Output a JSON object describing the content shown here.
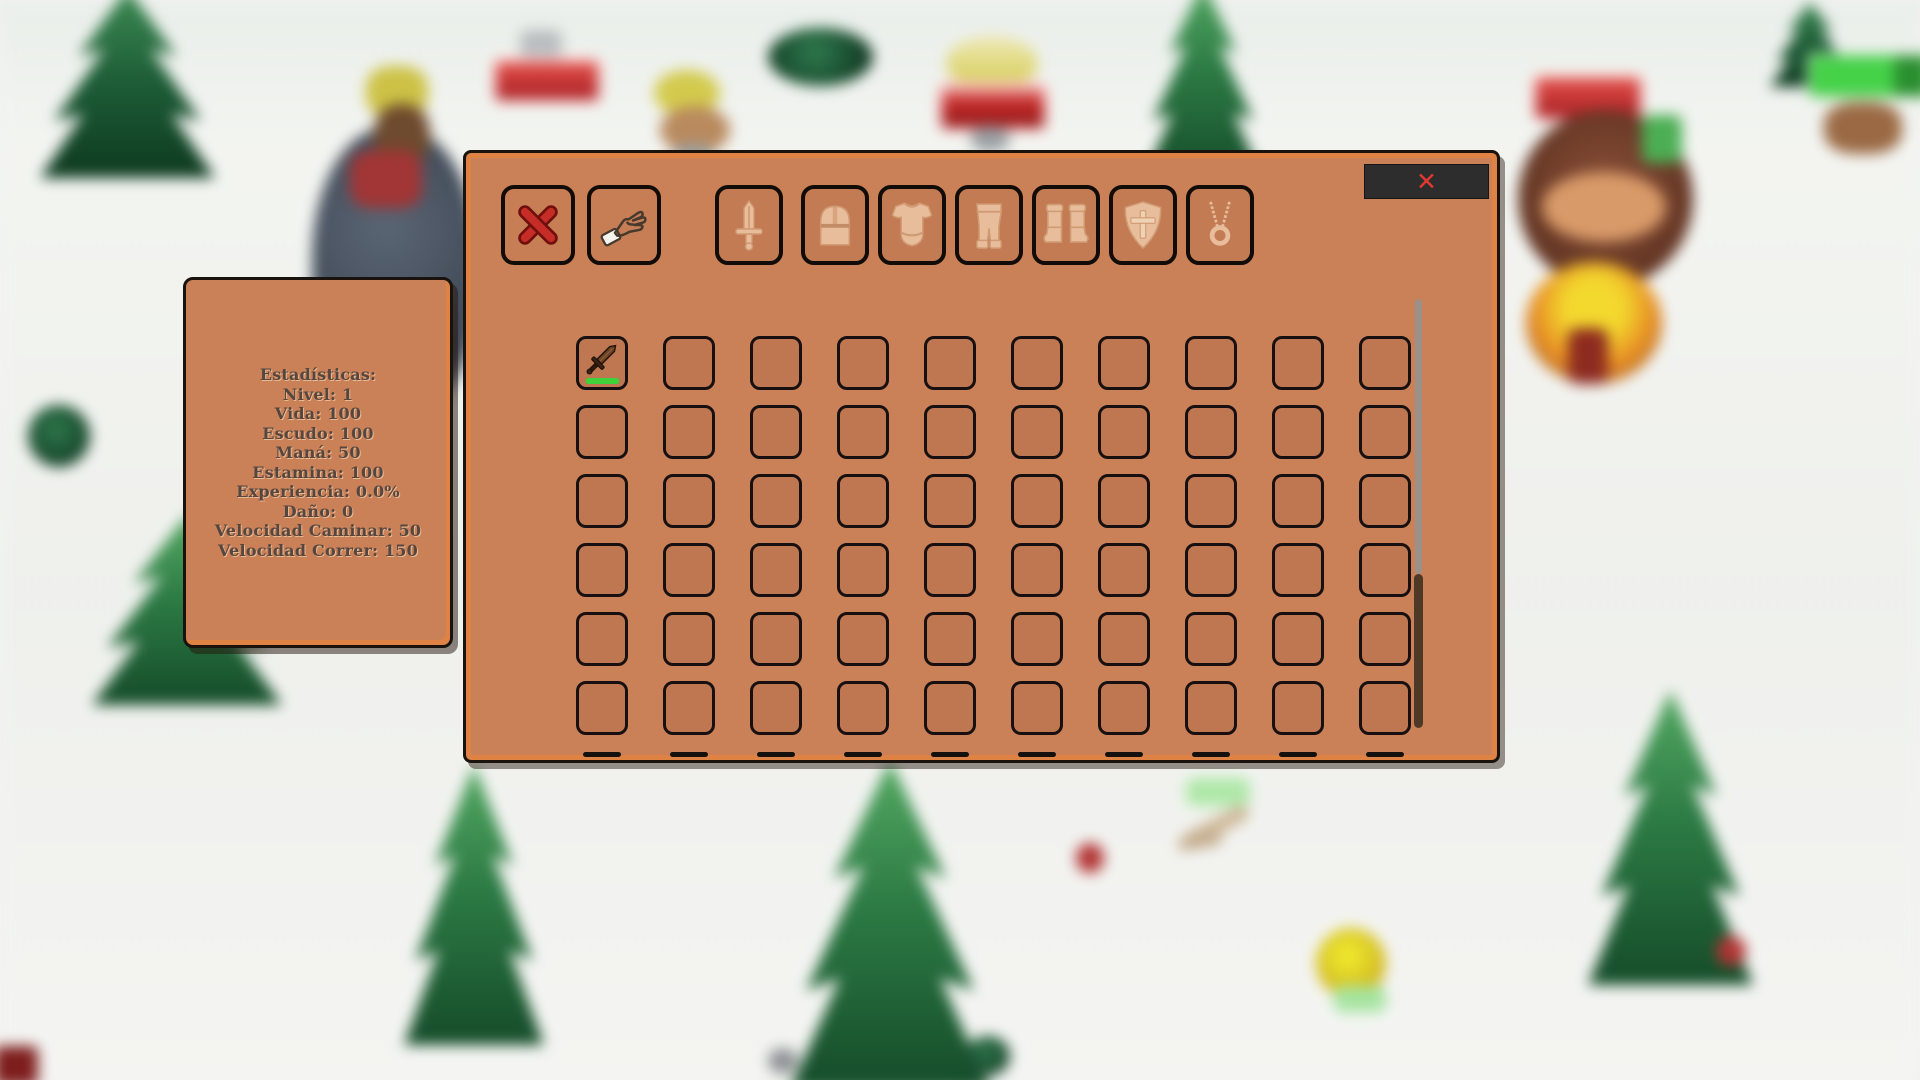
{
  "colors": {
    "panel_fill": "#cb8157",
    "panel_edge_highlight": "#de8343",
    "panel_outline": "#1a120c",
    "slot_outline": "#181010",
    "ghost_icon": "#eec9a9",
    "ghost_icon_stroke": "#d3a078",
    "destroy_x_red": "#c62d26",
    "close_bar_bg": "#2d2d2d",
    "close_x_red": "#e23a30",
    "durability_green": "#3fd23a",
    "scrollbar_track": "#9b918a",
    "scrollbar_thumb": "#4e3926",
    "stats_text": "#55463f"
  },
  "hud": {
    "stats_panel": {
      "title": "Estadísticas:",
      "lines": [
        "Nivel: 1",
        "Vida: 100",
        "Escudo: 100",
        "Maná: 50",
        "Estamina: 100",
        "Experiencia: 0.0%",
        "Daño: 0",
        "Velocidad Caminar: 50",
        "Velocidad Correr: 150"
      ]
    },
    "inventory": {
      "close_label": "✕",
      "action_buttons": [
        {
          "id": "destroy",
          "icon": "red-x-icon"
        },
        {
          "id": "drop",
          "icon": "hand-icon"
        }
      ],
      "equipment_slots": [
        {
          "id": "weapon",
          "icon": "sword-icon"
        },
        {
          "id": "helmet",
          "icon": "helmet-icon"
        },
        {
          "id": "chestplate",
          "icon": "chestplate-icon"
        },
        {
          "id": "leggings",
          "icon": "leggings-icon"
        },
        {
          "id": "boots",
          "icon": "boots-icon"
        },
        {
          "id": "shield",
          "icon": "shield-icon"
        },
        {
          "id": "amulet",
          "icon": "amulet-icon"
        }
      ],
      "grid": {
        "columns": 10,
        "rows": 6,
        "next_row_peek": true,
        "items": [
          {
            "row": 0,
            "col": 0,
            "name": "sword",
            "durability_pct": 100,
            "durability_color": "#3fd23a"
          }
        ]
      },
      "scrollbar": {
        "thumb_position": "lower-half"
      }
    }
  }
}
